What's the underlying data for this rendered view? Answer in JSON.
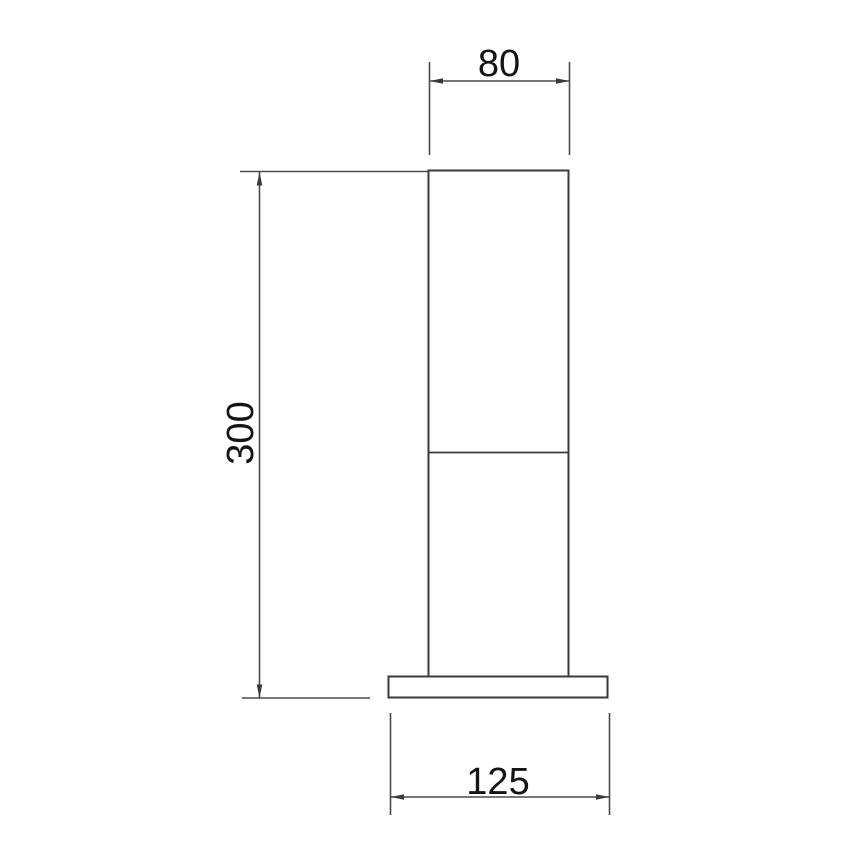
{
  "drawing": {
    "dimensions": {
      "top_width": "80",
      "height": "300",
      "base_width": "125"
    },
    "colors": {
      "background": "#ffffff",
      "outline": "#3a3a3a",
      "dimension_line": "#4a4a4a",
      "text": "#141414"
    }
  }
}
